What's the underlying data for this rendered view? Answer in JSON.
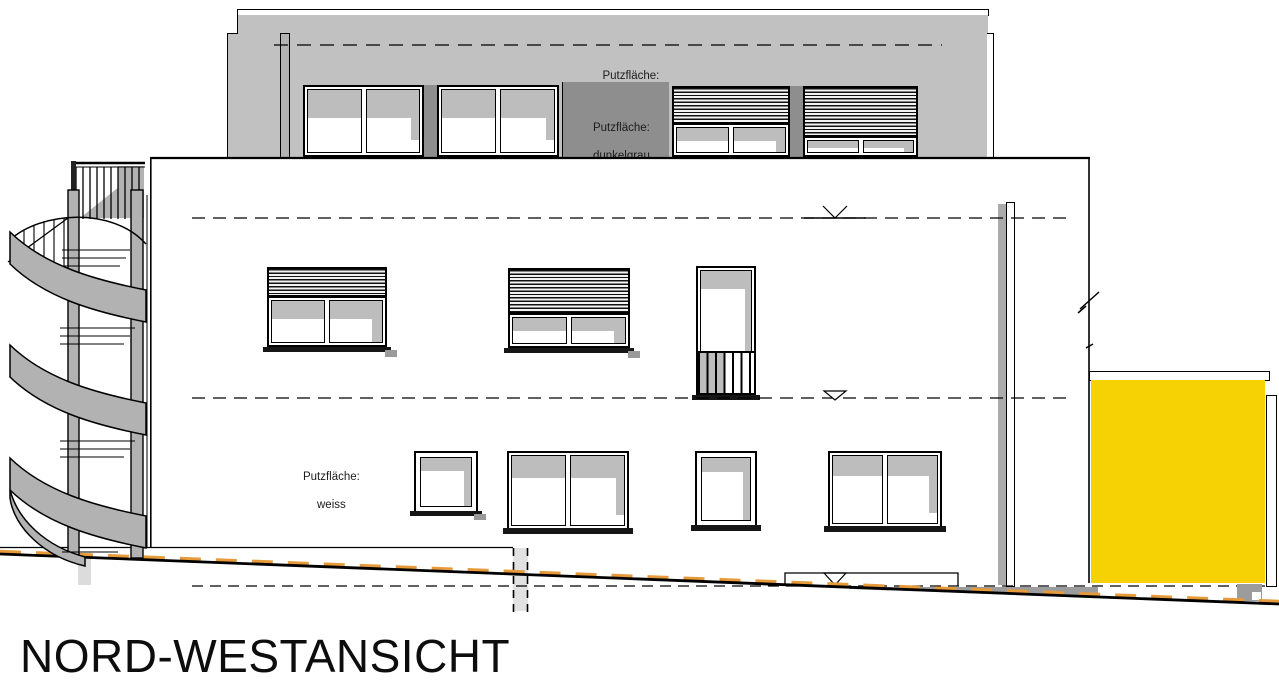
{
  "title": "NORD-WESTANSICHT",
  "labels": {
    "hellgrau": {
      "line1": "Putzfläche:",
      "line2": "hellgrau"
    },
    "dunkelgrau": {
      "line1": "Putzfläche:",
      "line2": "dunkelgrau"
    },
    "weiss": {
      "line1": "Putzfläche:",
      "line2": "weiss"
    }
  },
  "colors": {
    "light_gray": "#c1c1c1",
    "dark_gray": "#8e8e8e",
    "mid_gray": "#b2b2b2",
    "shade_gray": "#bdbdbd",
    "ground_gray": "#9c9c9c",
    "pale_gray": "#dedede",
    "accent_yellow": "#f6d104",
    "dash_orange": "#e79a3a",
    "line_black": "#000000"
  }
}
